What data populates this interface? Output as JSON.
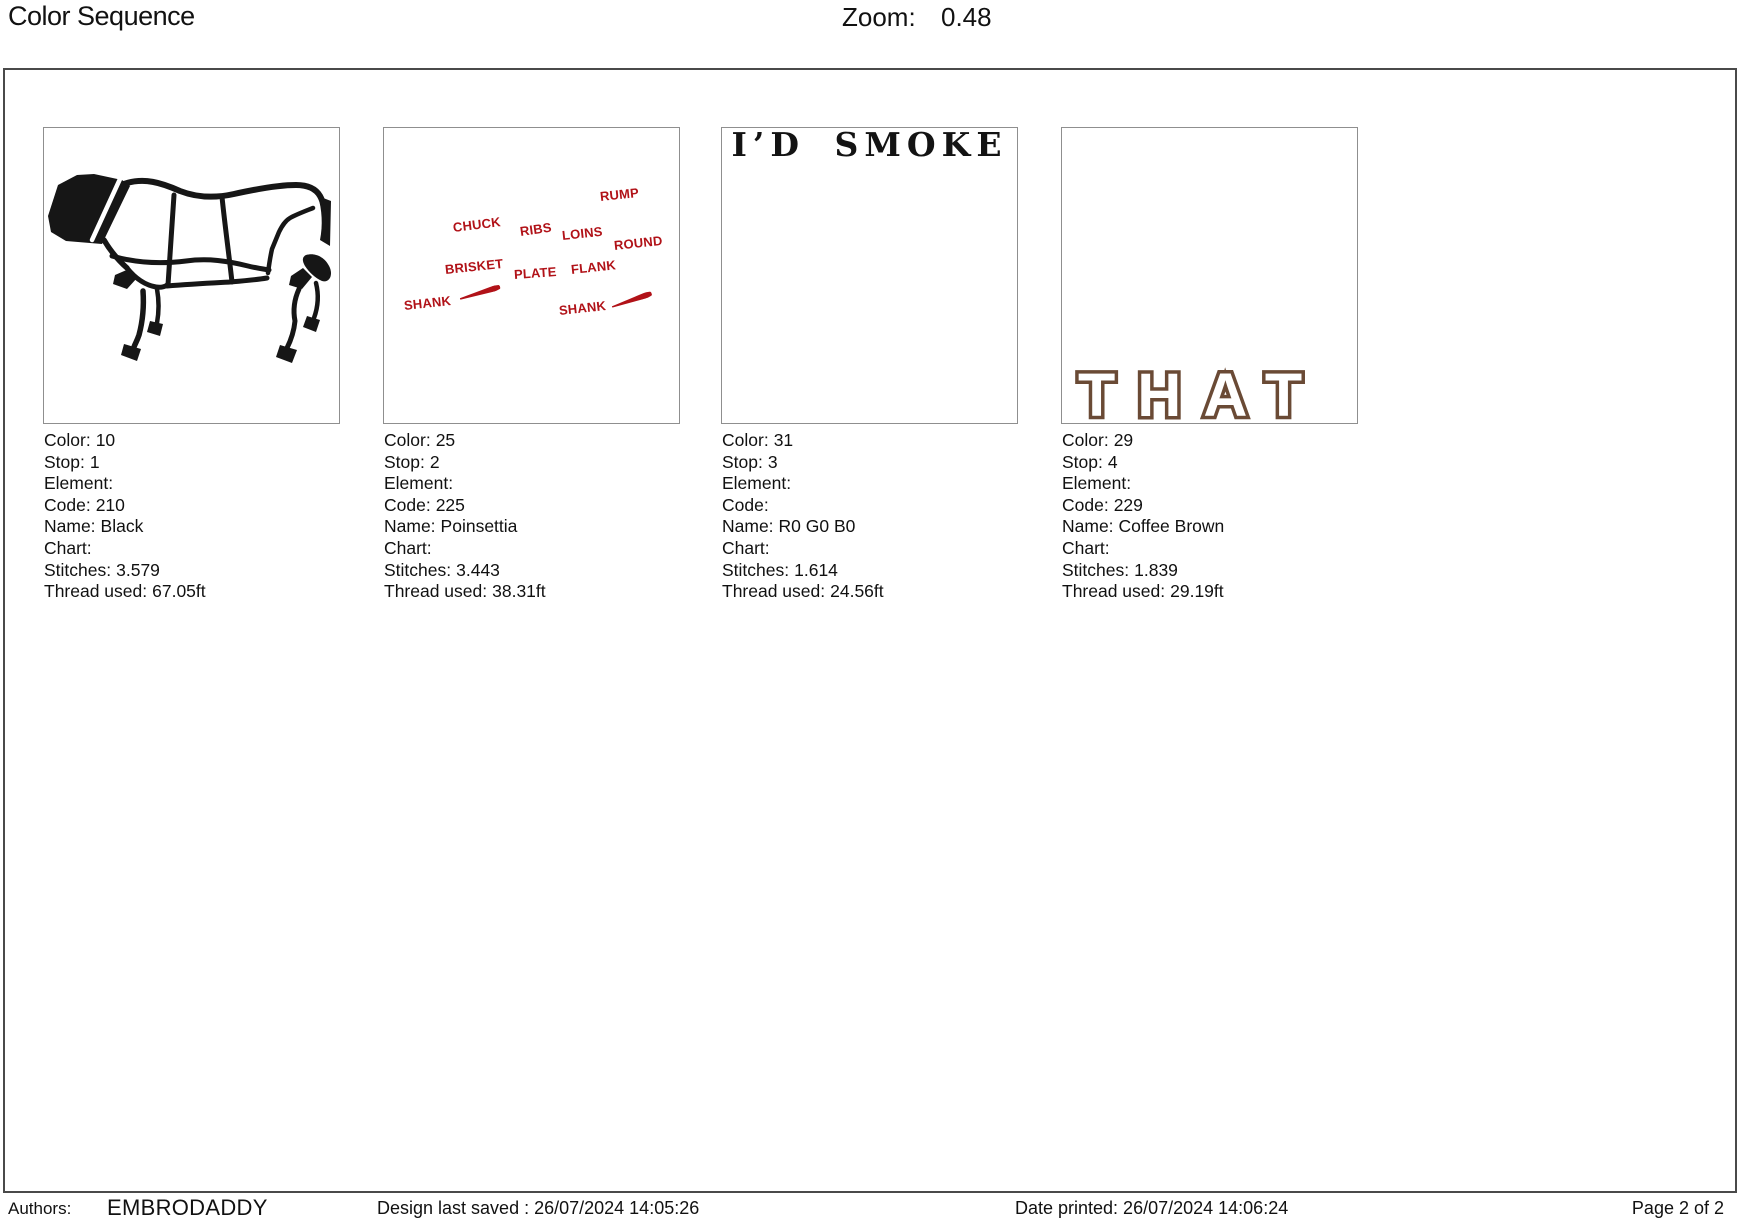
{
  "header": {
    "title": "Color Sequence",
    "zoom_label": "Zoom:",
    "zoom_value": "0.48"
  },
  "colors": {
    "stitch_black": "#141414",
    "stitch_red": "#B11218",
    "stitch_brown": "#6A4A35"
  },
  "stops": [
    {
      "thumbnail": "cow-cuts-diagram",
      "fields": [
        {
          "label": "Color:",
          "value": "10"
        },
        {
          "label": "Stop:",
          "value": "1"
        },
        {
          "label": "Element:",
          "value": ""
        },
        {
          "label": "Code:",
          "value": "210"
        },
        {
          "label": "Name:",
          "value": "Black"
        },
        {
          "label": "Chart:",
          "value": ""
        },
        {
          "label": "Stitches:",
          "value": "3.579"
        },
        {
          "label": "Thread used:",
          "value": "67.05ft"
        }
      ]
    },
    {
      "thumbnail": "beef-cut-name-labels",
      "labels": [
        "RUMP",
        "CHUCK",
        "RIBS",
        "LOINS",
        "ROUND",
        "BRISKET",
        "PLATE",
        "FLANK",
        "SHANK",
        "SHANK"
      ],
      "fields": [
        {
          "label": "Color:",
          "value": "25"
        },
        {
          "label": "Stop:",
          "value": "2"
        },
        {
          "label": "Element:",
          "value": ""
        },
        {
          "label": "Code:",
          "value": "225"
        },
        {
          "label": "Name:",
          "value": "Poinsettia"
        },
        {
          "label": "Chart:",
          "value": ""
        },
        {
          "label": "Stitches:",
          "value": "3.443"
        },
        {
          "label": "Thread used:",
          "value": "38.31ft"
        }
      ]
    },
    {
      "thumbnail": "id-smoke-lettering",
      "text": "I’D SMOKE",
      "fields": [
        {
          "label": "Color:",
          "value": "31"
        },
        {
          "label": "Stop:",
          "value": "3"
        },
        {
          "label": "Element:",
          "value": ""
        },
        {
          "label": "Code:",
          "value": ""
        },
        {
          "label": "Name:",
          "value": "R0 G0 B0"
        },
        {
          "label": "Chart:",
          "value": ""
        },
        {
          "label": "Stitches:",
          "value": "1.614"
        },
        {
          "label": "Thread used:",
          "value": "24.56ft"
        }
      ]
    },
    {
      "thumbnail": "that-outline-lettering",
      "text": "THAT",
      "fields": [
        {
          "label": "Color:",
          "value": "29"
        },
        {
          "label": "Stop:",
          "value": "4"
        },
        {
          "label": "Element:",
          "value": ""
        },
        {
          "label": "Code:",
          "value": "229"
        },
        {
          "label": "Name:",
          "value": "Coffee Brown"
        },
        {
          "label": "Chart:",
          "value": ""
        },
        {
          "label": "Stitches:",
          "value": "1.839"
        },
        {
          "label": "Thread used:",
          "value": "29.19ft"
        }
      ]
    }
  ],
  "footer": {
    "authors_label": "Authors:",
    "authors_value": "EMBRODADDY",
    "design_saved": "Design last saved : 26/07/2024 14:05:26",
    "date_printed": "Date printed: 26/07/2024 14:06:24",
    "page": "Page 2 of 2"
  }
}
